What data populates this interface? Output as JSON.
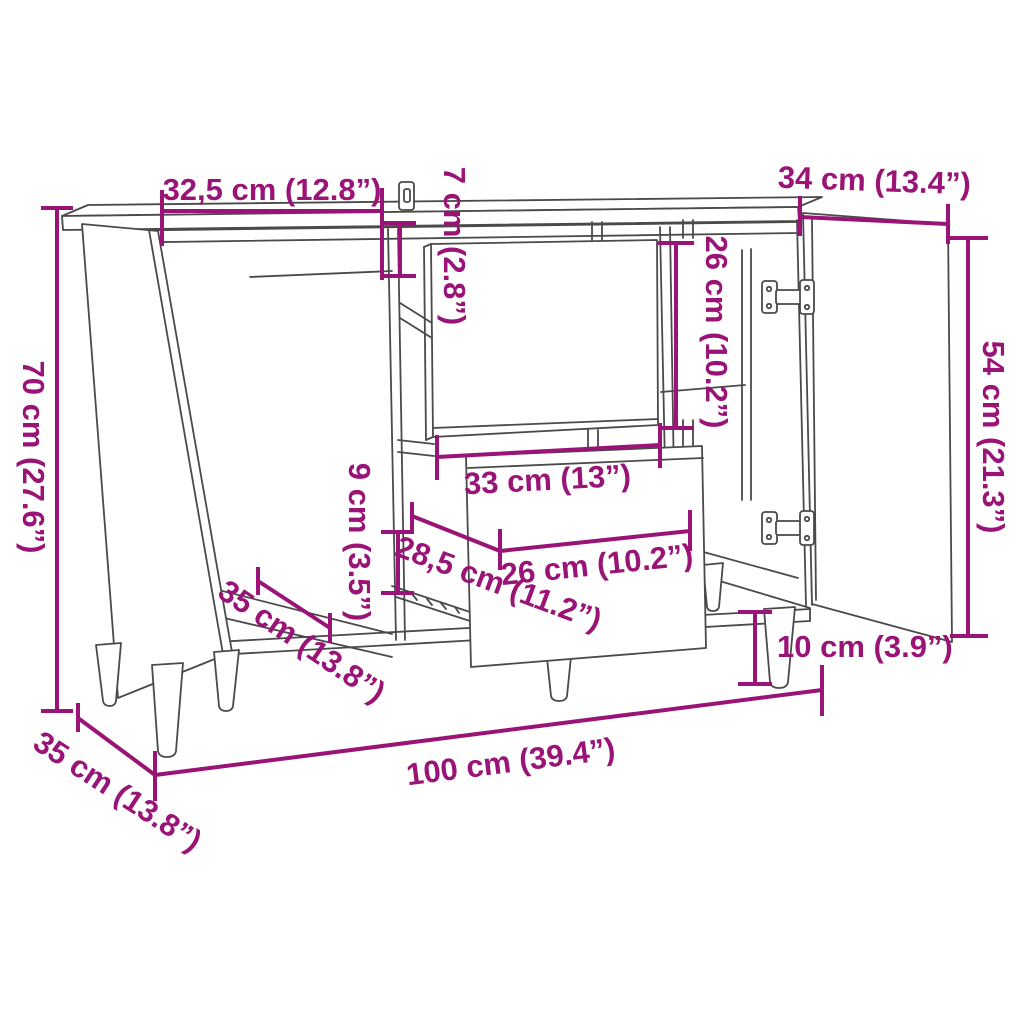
{
  "page": {
    "background": "#ffffff"
  },
  "diagram": {
    "type": "furniture-dimension-drawing",
    "subject": "sideboard with two open doors, one floating drawer front and one pulled-out drawer on tapered legs",
    "line_color": "#4a4a4a",
    "dimension_color": "#9a1377",
    "dimensions": [
      {
        "id": "left-door-width",
        "label": "32,5 cm (12.8”)",
        "orientation": "horizontal"
      },
      {
        "id": "top-rail-height",
        "label": "7 cm (2.8”)",
        "orientation": "vertical"
      },
      {
        "id": "right-door-width",
        "label": "34 cm (13.4”)",
        "orientation": "horizontal"
      },
      {
        "id": "overall-height",
        "label": "70 cm (27.6”)",
        "orientation": "vertical"
      },
      {
        "id": "door-height",
        "label": "54 cm (21.3”)",
        "orientation": "vertical"
      },
      {
        "id": "drawer-front-height",
        "label": "26 cm (10.2”)",
        "orientation": "vertical"
      },
      {
        "id": "drawer-side-height",
        "label": "9 cm (3.5”)",
        "orientation": "vertical"
      },
      {
        "id": "drawer-front-width",
        "label": "33 cm (13”)",
        "orientation": "horizontal"
      },
      {
        "id": "drawer-inner-depth",
        "label": "28,5 cm (11.2”)",
        "orientation": "diagonal"
      },
      {
        "id": "drawer-inner-width",
        "label": "26 cm (10.2”)",
        "orientation": "horizontal"
      },
      {
        "id": "compartment-depth",
        "label": "35 cm (13.8”)",
        "orientation": "diagonal"
      },
      {
        "id": "leg-height",
        "label": "10 cm (3.9”)",
        "orientation": "vertical"
      },
      {
        "id": "overall-width",
        "label": "100 cm (39.4”)",
        "orientation": "horizontal"
      },
      {
        "id": "overall-depth",
        "label": "35 cm (13.8”)",
        "orientation": "diagonal"
      }
    ]
  }
}
